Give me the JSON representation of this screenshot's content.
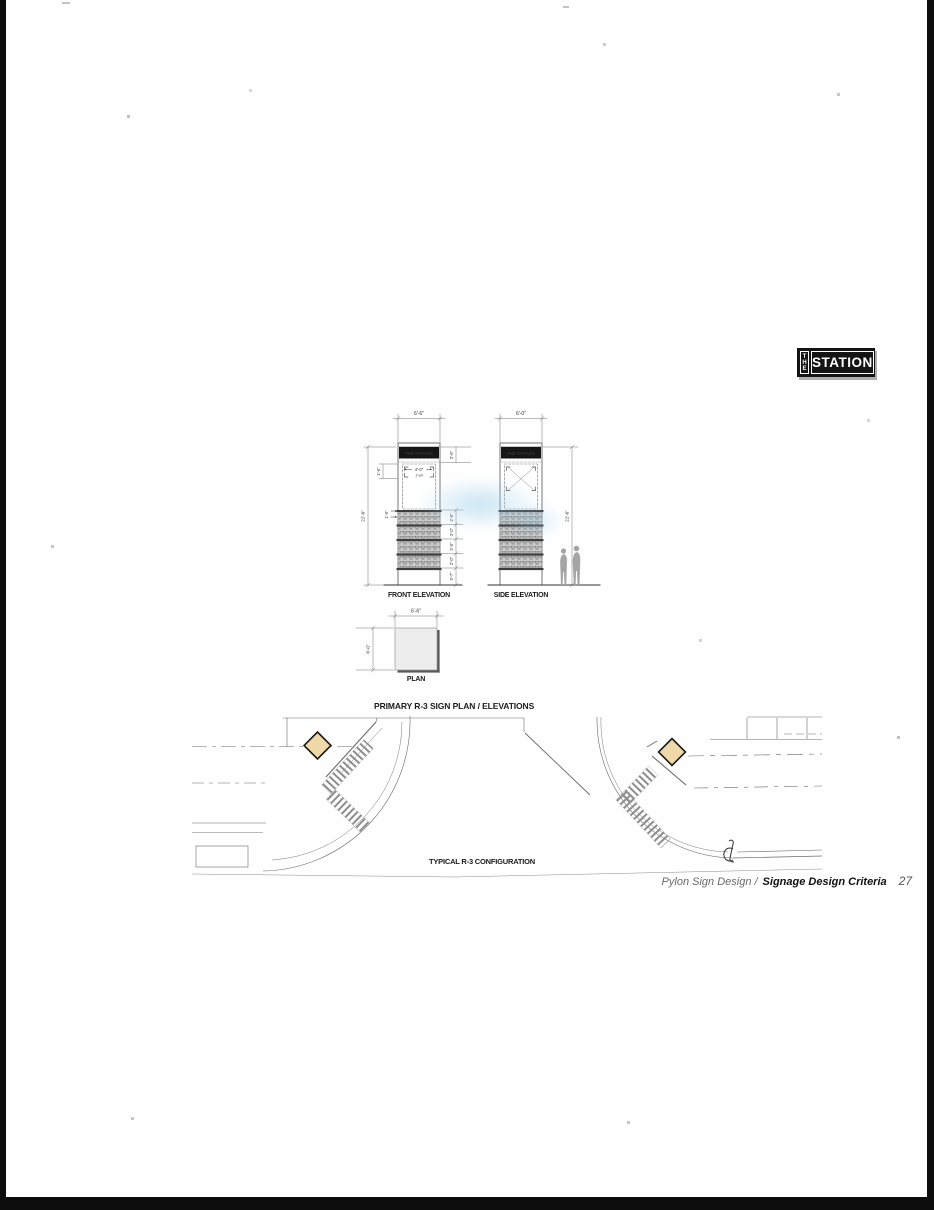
{
  "logo": {
    "the": "THE",
    "station": "STATION"
  },
  "elevations": {
    "front": {
      "label": "FRONT ELEVATION",
      "sign_text": "THE STATION",
      "width": "6'-6\"",
      "height": "22'-6\"",
      "band_height": "2'-6\"",
      "bracket_height": "1'-6\"",
      "typ_width": "4'-0\"",
      "typ": "-TYP.",
      "row_offset": "1'-0\"",
      "rows": [
        "2'-0\"",
        "2'-0\"",
        "2'-0\"",
        "2'-0\""
      ],
      "base": "3'-7\""
    },
    "side": {
      "label": "SIDE ELEVATION",
      "sign_text": "THE STATION",
      "width": "6'-0\"",
      "height": "22'-6\""
    },
    "plan": {
      "label": "PLAN",
      "width": "6'-6\"",
      "depth": "6'-0\""
    }
  },
  "titles": {
    "primary": "PRIMARY R-3 SIGN PLAN / ELEVATIONS",
    "site": "TYPICAL R-3 CONFIGURATION"
  },
  "footer": {
    "section": "Pylon Sign Design /",
    "document": "Signage Design Criteria",
    "page_number": "27"
  },
  "colors": {
    "sign_marker": "#f0d8a8",
    "sign_band": "#161616",
    "figure_gray": "#a5a5a5"
  }
}
